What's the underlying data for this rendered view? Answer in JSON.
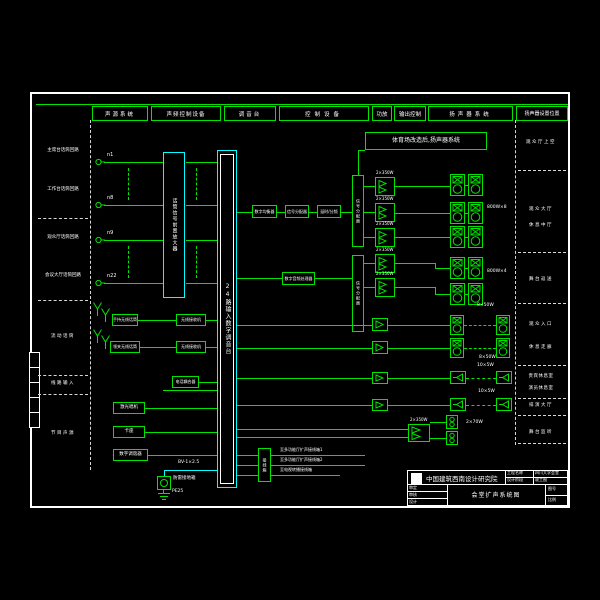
{
  "header_columns": [
    "声源系统",
    "声频控制设备",
    "调音台",
    "控制设备",
    "功放",
    "输出控制",
    "扬声器系统",
    "扬声器设置位置"
  ],
  "left_sections": [
    "主席台话筒回路",
    "工作台话筒回路",
    "观众厅话筒回路",
    "会议大厅话筒回路",
    "流动话筒",
    "线路输入",
    "节目声源"
  ],
  "mic_labels": [
    "n1",
    "n8",
    "n9",
    "n22"
  ],
  "equipment": {
    "preamp": "话筒信号前置放大器",
    "mixer": "24路输入数字调音台",
    "eq": "数字均衡器",
    "splitter": "信号分配器",
    "delay": "延时/分频",
    "processor": "数字音频处理器",
    "dist_a": "信号分配器",
    "dist_b": "信号分配器",
    "junction": "接线箱",
    "wireless_handheld": "手持无线话筒",
    "wireless_lavalier": "领夹无线话筒",
    "receiver": "无线接收机",
    "coupler": "电话耦合器",
    "cd": "激光唱机",
    "tape": "卡座",
    "tuner": "数字调谐器",
    "amp_model": "2×350W"
  },
  "banner": "体育场改造后,扬声器系统",
  "power_labels": [
    "800W×8",
    "800W×4",
    "8×50W",
    "8×50W",
    "10×5W",
    "10×5W",
    "2×70W"
  ],
  "speaker_positions": [
    "观众厅上空",
    "观众大厅",
    "休息中厅",
    "舞台返送",
    "观众入口",
    "休息走廊",
    "贵宾休息室",
    "演员休息室",
    "排演大厅",
    "舞台监听"
  ],
  "junction_lines": [
    "至多功能厅扩声接线箱1",
    "至多功能厅扩声接线箱2",
    "至电视转播接线箱"
  ],
  "grounding": {
    "cable": "BV-1×2.5",
    "box": "防雷接地箱",
    "terminal": "PE25"
  },
  "titleblock": {
    "institute": "中国建筑西南设计研究院",
    "project_label": "工程名称",
    "project_name": "四川大学会堂",
    "stage_label": "设计阶段",
    "stage": "竣工图",
    "drawing_title": "会堂扩声系统图",
    "sign_labels": [
      "审定",
      "审核",
      "设计"
    ],
    "no_label": "图号",
    "scale_label": "比例"
  }
}
